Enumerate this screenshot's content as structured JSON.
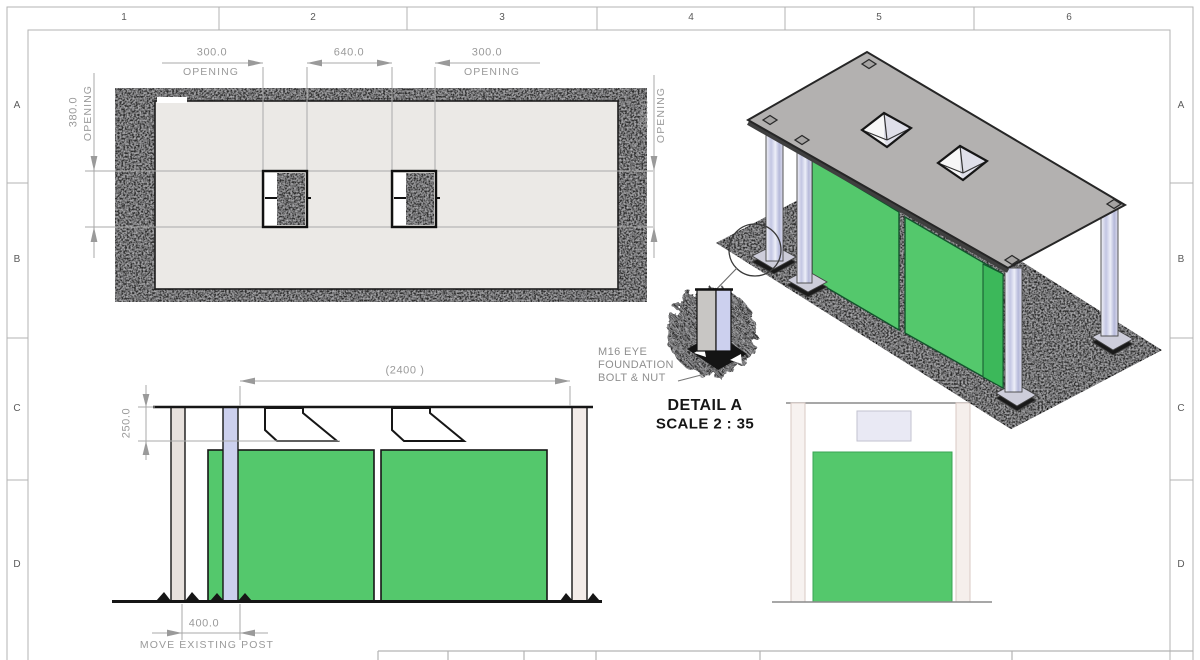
{
  "sheet": {
    "column_labels": [
      "1",
      "2",
      "3",
      "4",
      "5",
      "6"
    ],
    "row_labels": [
      "A",
      "B",
      "C",
      "D"
    ]
  },
  "plan_view": {
    "dim_opening_left_value": "300.0",
    "dim_opening_left_label": "OPENING",
    "dim_center_value": "640.0",
    "dim_opening_right_value": "300.0",
    "dim_opening_right_label": "OPENING",
    "dim_side_left_value": "380.0",
    "dim_side_left_label": "OPENING",
    "dim_side_right_value": "380.0",
    "dim_side_right_label": "OPENING"
  },
  "elevation_view": {
    "dim_overall_width": "(2400 )",
    "dim_roof_to_panel": "250.0",
    "dim_post_offset": "400.0",
    "note_move_post": "MOVE EXISTING POST"
  },
  "detail_view": {
    "callout": [
      "M16 EYE",
      "FOUNDATION",
      "BOLT & NUT"
    ],
    "title": "DETAIL A",
    "scale_label": "SCALE 2 : 35"
  },
  "colors": {
    "panel_green": "#54c86c",
    "panel_green_dark": "#3cb85a",
    "roof_gray": "#b3b1b0",
    "post_lavender": "#ccd0ee",
    "concrete_dark": "#2d2d2d",
    "dim_gray": "#9a9a9a"
  }
}
